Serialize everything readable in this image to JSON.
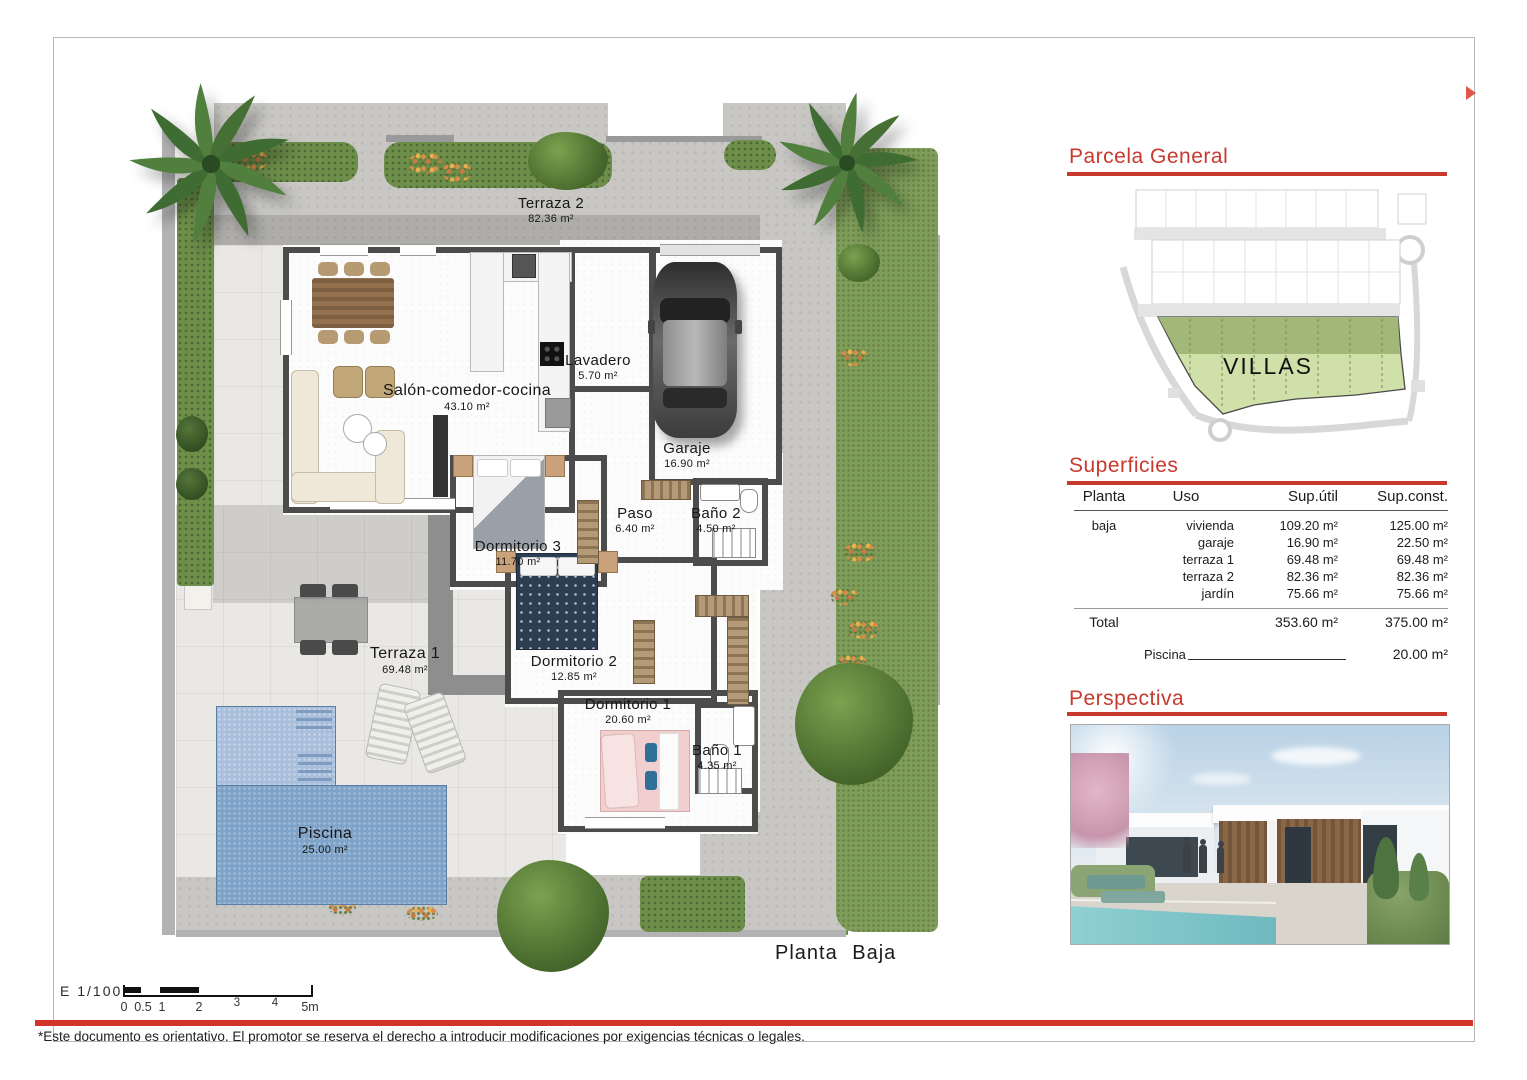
{
  "page": {
    "plan_title": "Planta Baja",
    "scale_label": "E 1/100",
    "scale_ticks": [
      "0",
      "0.5",
      "1",
      "2",
      "3",
      "4",
      "5m"
    ],
    "footer_disclaimer": "*Este documento es orientativo. El promotor se reserva el derecho a introducir modificaciones por exigencias técnicas o legales."
  },
  "colors": {
    "accent_red": "#c8392e",
    "wall": "#4c4c4c",
    "pool_blue": "#7fa3c8",
    "lawn_green": "#7f9e59",
    "parcel_green_light": "#cfe0a8",
    "parcel_green_dark": "#a2b878"
  },
  "plan": {
    "rooms": [
      {
        "name": "Terraza  2",
        "area": "82.36  m²"
      },
      {
        "name": "Salón-comedor-cocina",
        "area": "43.10  m²"
      },
      {
        "name": "Lavadero",
        "area": "5.70  m²"
      },
      {
        "name": "Garaje",
        "area": "16.90  m²"
      },
      {
        "name": "Paso",
        "area": "6.40  m²"
      },
      {
        "name": "Baño 2",
        "area": "4.50  m²"
      },
      {
        "name": "Dormitorio 3",
        "area": "11.70  m²"
      },
      {
        "name": "Dormitorio 2",
        "area": "12.85  m²"
      },
      {
        "name": "Dormitorio 1",
        "area": "20.60  m²"
      },
      {
        "name": "Baño 1",
        "area": "4.35  m²"
      },
      {
        "name": "Terraza  1",
        "area": "69.48  m²"
      },
      {
        "name": "Piscina",
        "area": "25.00  m²"
      }
    ]
  },
  "sidebar": {
    "parcela": {
      "title": "Parcela  General",
      "zone_label": "VILLAS"
    },
    "superficies": {
      "title": "Superficies",
      "columns": [
        "Planta",
        "Uso",
        "Sup.útil",
        "Sup.const."
      ],
      "rows": [
        {
          "planta": "baja",
          "uso": "vivienda",
          "util": "109.20  m²",
          "const": "125.00  m²"
        },
        {
          "planta": "",
          "uso": "garaje",
          "util": "16.90  m²",
          "const": "22.50  m²"
        },
        {
          "planta": "",
          "uso": "terraza  1",
          "util": "69.48  m²",
          "const": "69.48  m²"
        },
        {
          "planta": "",
          "uso": "terraza  2",
          "util": "82.36  m²",
          "const": "82.36  m²"
        },
        {
          "planta": "",
          "uso": "jardín",
          "util": "75.66  m²",
          "const": "75.66  m²"
        }
      ],
      "total": {
        "label": "Total",
        "util": "353.60  m²",
        "const": "375.00  m²"
      },
      "piscina": {
        "label": "Piscina",
        "value": "20.00  m²"
      }
    },
    "perspectiva": {
      "title": "Perspectiva"
    }
  }
}
